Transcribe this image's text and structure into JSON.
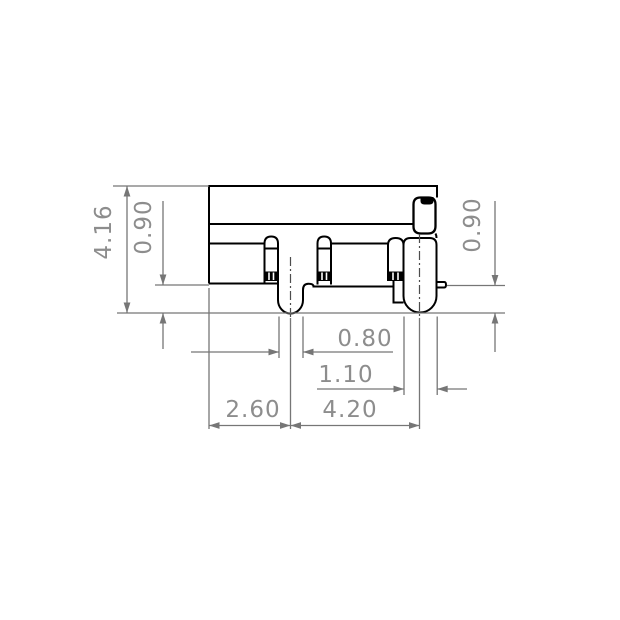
{
  "drawing": {
    "type": "technical-dimension-drawing",
    "view": "connector-side-profile",
    "units_shown": false,
    "dimensions": {
      "overall_height": "4.16",
      "left_standoff_height": "0.90",
      "right_standoff_height": "0.90",
      "left_lead_width": "0.80",
      "right_lead_width": "1.10",
      "body_edge_to_left_lead_center": "2.60",
      "left_lead_to_right_lead_pitch": "4.20"
    },
    "colors": {
      "background": "#ffffff",
      "part_outline": "#000000",
      "dimension_lines": "#767676",
      "dimension_text": "#8d8d8d"
    }
  }
}
